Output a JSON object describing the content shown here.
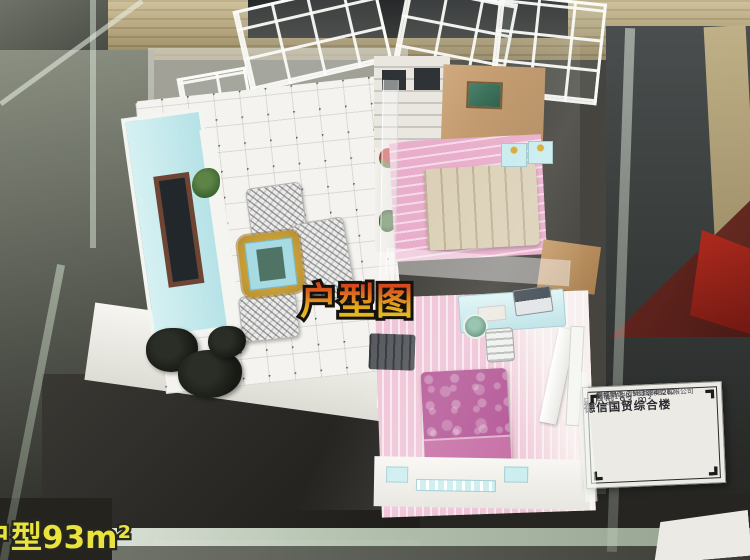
{
  "scene": {
    "subject": "apartment scale model displayed inside a glass case"
  },
  "overlay": {
    "center_caption": "户型图",
    "bottom_caption": "户型93m²"
  },
  "placard": {
    "title": "德信国贸综合楼",
    "unit_line": "E 户型 93 m²",
    "scale_line": "比例: 1:20",
    "maker_line": "模型制作:创新建筑模型有限公司",
    "phone_line": "制作电话: 15838848282"
  },
  "colors": {
    "caption_gradient_top": "#d7481c",
    "caption_gradient_bottom": "#e5c31e",
    "caption_outline": "#14110e",
    "bottom_caption_yellow": "#e9e43d",
    "placard_background": "#ebeae5",
    "wood_shelf": "#b7a77c",
    "table_surface": "#2c2b27",
    "glass_edge_green": "#d9e7d3",
    "tv_wall_cyan": "#c5eaec",
    "coffee_table_blue": "#a6dbe4",
    "coffee_table_gold": "#c9a23c",
    "bedroom_floor_pink": "#eeb6d0",
    "bed_beige": "#dcd1b8",
    "bed_magenta": "#b75d9a",
    "furniture_cyan": "#cdeef0",
    "background_maroon": "#772820",
    "background_red": "#b22a1e"
  }
}
